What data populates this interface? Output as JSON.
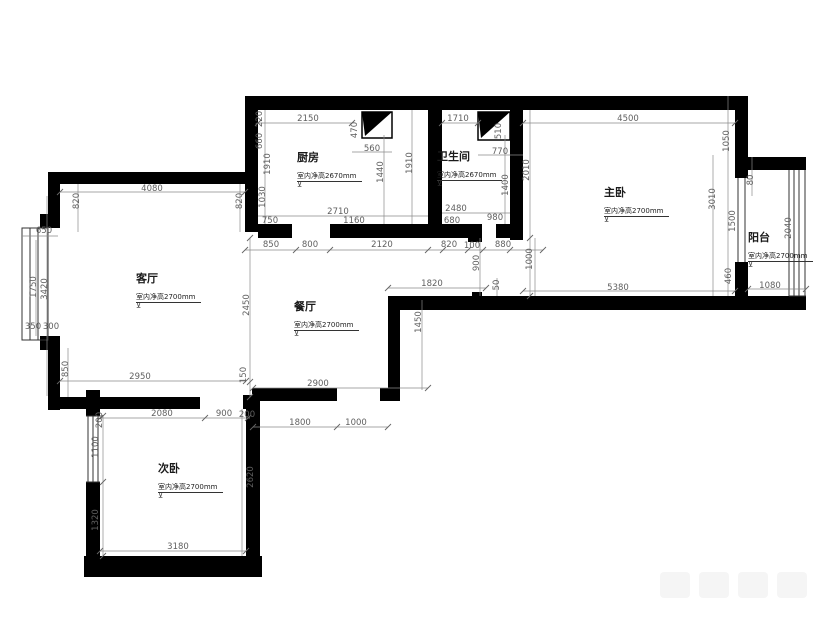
{
  "colors": {
    "wall": "#000000",
    "dimension_text": "#5f5f5f",
    "dimension_line": "#8a8a8a",
    "window_line": "#333333"
  },
  "symbols": {
    "level_mark": "⊻"
  },
  "rooms": [
    {
      "id": "kitchen",
      "name": "厨房",
      "note": "室内净高2670mm",
      "x": 297,
      "y": 152
    },
    {
      "id": "bathroom",
      "name": "卫生间",
      "note": "室内净高2670mm",
      "x": 437,
      "y": 151
    },
    {
      "id": "master-bedroom",
      "name": "主卧",
      "note": "室内净高2700mm",
      "x": 604,
      "y": 187
    },
    {
      "id": "balcony",
      "name": "阳台",
      "note": "室内净高2700mm",
      "x": 748,
      "y": 232
    },
    {
      "id": "living-room",
      "name": "客厅",
      "note": "室内净高2700mm",
      "x": 136,
      "y": 273
    },
    {
      "id": "dining-room",
      "name": "餐厅",
      "note": "室内净高2700mm",
      "x": 294,
      "y": 301
    },
    {
      "id": "second-bedroom",
      "name": "次卧",
      "note": "室内净高2700mm",
      "x": 158,
      "y": 463
    }
  ],
  "dims": [
    {
      "t": "2150",
      "x": 308,
      "y": 119,
      "v": 0
    },
    {
      "t": "470",
      "x": 355,
      "y": 130,
      "v": 1
    },
    {
      "t": "560",
      "x": 372,
      "y": 149,
      "v": 0
    },
    {
      "t": "1710",
      "x": 458,
      "y": 119,
      "v": 0
    },
    {
      "t": "510",
      "x": 499,
      "y": 131,
      "v": 1
    },
    {
      "t": "770",
      "x": 500,
      "y": 152,
      "v": 0
    },
    {
      "t": "4500",
      "x": 628,
      "y": 119,
      "v": 0
    },
    {
      "t": "220",
      "x": 260,
      "y": 119,
      "v": 1
    },
    {
      "t": "660",
      "x": 260,
      "y": 141,
      "v": 1
    },
    {
      "t": "1910",
      "x": 268,
      "y": 164,
      "v": 1
    },
    {
      "t": "1030",
      "x": 263,
      "y": 197,
      "v": 1
    },
    {
      "t": "1440",
      "x": 381,
      "y": 172,
      "v": 1
    },
    {
      "t": "1910",
      "x": 410,
      "y": 163,
      "v": 1
    },
    {
      "t": "1400",
      "x": 506,
      "y": 185,
      "v": 1
    },
    {
      "t": "2010",
      "x": 527,
      "y": 170,
      "v": 1
    },
    {
      "t": "2710",
      "x": 338,
      "y": 212,
      "v": 0
    },
    {
      "t": "750",
      "x": 270,
      "y": 221,
      "v": 0
    },
    {
      "t": "1160",
      "x": 354,
      "y": 221,
      "v": 0
    },
    {
      "t": "2480",
      "x": 456,
      "y": 209,
      "v": 0
    },
    {
      "t": "680",
      "x": 452,
      "y": 221,
      "v": 0
    },
    {
      "t": "980",
      "x": 495,
      "y": 218,
      "v": 0
    },
    {
      "t": "1050",
      "x": 727,
      "y": 141,
      "v": 1
    },
    {
      "t": "3010",
      "x": 713,
      "y": 199,
      "v": 1
    },
    {
      "t": "80",
      "x": 751,
      "y": 180,
      "v": 1
    },
    {
      "t": "1500",
      "x": 733,
      "y": 221,
      "v": 1
    },
    {
      "t": "460",
      "x": 729,
      "y": 276,
      "v": 1
    },
    {
      "t": "2040",
      "x": 789,
      "y": 228,
      "v": 1
    },
    {
      "t": "1080",
      "x": 770,
      "y": 286,
      "v": 0
    },
    {
      "t": "1000",
      "x": 530,
      "y": 259,
      "v": 1
    },
    {
      "t": "5380",
      "x": 618,
      "y": 288,
      "v": 0
    },
    {
      "t": "850",
      "x": 271,
      "y": 245,
      "v": 0
    },
    {
      "t": "800",
      "x": 310,
      "y": 245,
      "v": 0
    },
    {
      "t": "2120",
      "x": 382,
      "y": 245,
      "v": 0
    },
    {
      "t": "820",
      "x": 449,
      "y": 245,
      "v": 0
    },
    {
      "t": "100",
      "x": 472,
      "y": 246,
      "v": 0
    },
    {
      "t": "880",
      "x": 503,
      "y": 245,
      "v": 0
    },
    {
      "t": "900",
      "x": 477,
      "y": 263,
      "v": 1
    },
    {
      "t": "50",
      "x": 497,
      "y": 285,
      "v": 1
    },
    {
      "t": "1820",
      "x": 432,
      "y": 284,
      "v": 0
    },
    {
      "t": "4080",
      "x": 152,
      "y": 189,
      "v": 0
    },
    {
      "t": "820",
      "x": 77,
      "y": 201,
      "v": 1
    },
    {
      "t": "820",
      "x": 240,
      "y": 201,
      "v": 1
    },
    {
      "t": "650",
      "x": 44,
      "y": 231,
      "v": 0
    },
    {
      "t": "1750",
      "x": 34,
      "y": 287,
      "v": 1
    },
    {
      "t": "3420",
      "x": 45,
      "y": 289,
      "v": 1
    },
    {
      "t": "350",
      "x": 33,
      "y": 327,
      "v": 0
    },
    {
      "t": "300",
      "x": 51,
      "y": 327,
      "v": 0
    },
    {
      "t": "850",
      "x": 66,
      "y": 369,
      "v": 1
    },
    {
      "t": "2950",
      "x": 140,
      "y": 377,
      "v": 0
    },
    {
      "t": "2450",
      "x": 247,
      "y": 305,
      "v": 1
    },
    {
      "t": "150",
      "x": 244,
      "y": 375,
      "v": 1
    },
    {
      "t": "2900",
      "x": 318,
      "y": 384,
      "v": 0
    },
    {
      "t": "1800",
      "x": 300,
      "y": 423,
      "v": 0
    },
    {
      "t": "1000",
      "x": 356,
      "y": 423,
      "v": 0
    },
    {
      "t": "1450",
      "x": 419,
      "y": 322,
      "v": 1
    },
    {
      "t": "2080",
      "x": 162,
      "y": 414,
      "v": 0
    },
    {
      "t": "900",
      "x": 224,
      "y": 414,
      "v": 0
    },
    {
      "t": "200",
      "x": 247,
      "y": 415,
      "v": 0
    },
    {
      "t": "200",
      "x": 100,
      "y": 420,
      "v": 1
    },
    {
      "t": "1100",
      "x": 96,
      "y": 447,
      "v": 1
    },
    {
      "t": "1320",
      "x": 96,
      "y": 520,
      "v": 1
    },
    {
      "t": "2620",
      "x": 251,
      "y": 477,
      "v": 1
    },
    {
      "t": "3180",
      "x": 178,
      "y": 547,
      "v": 0
    }
  ]
}
